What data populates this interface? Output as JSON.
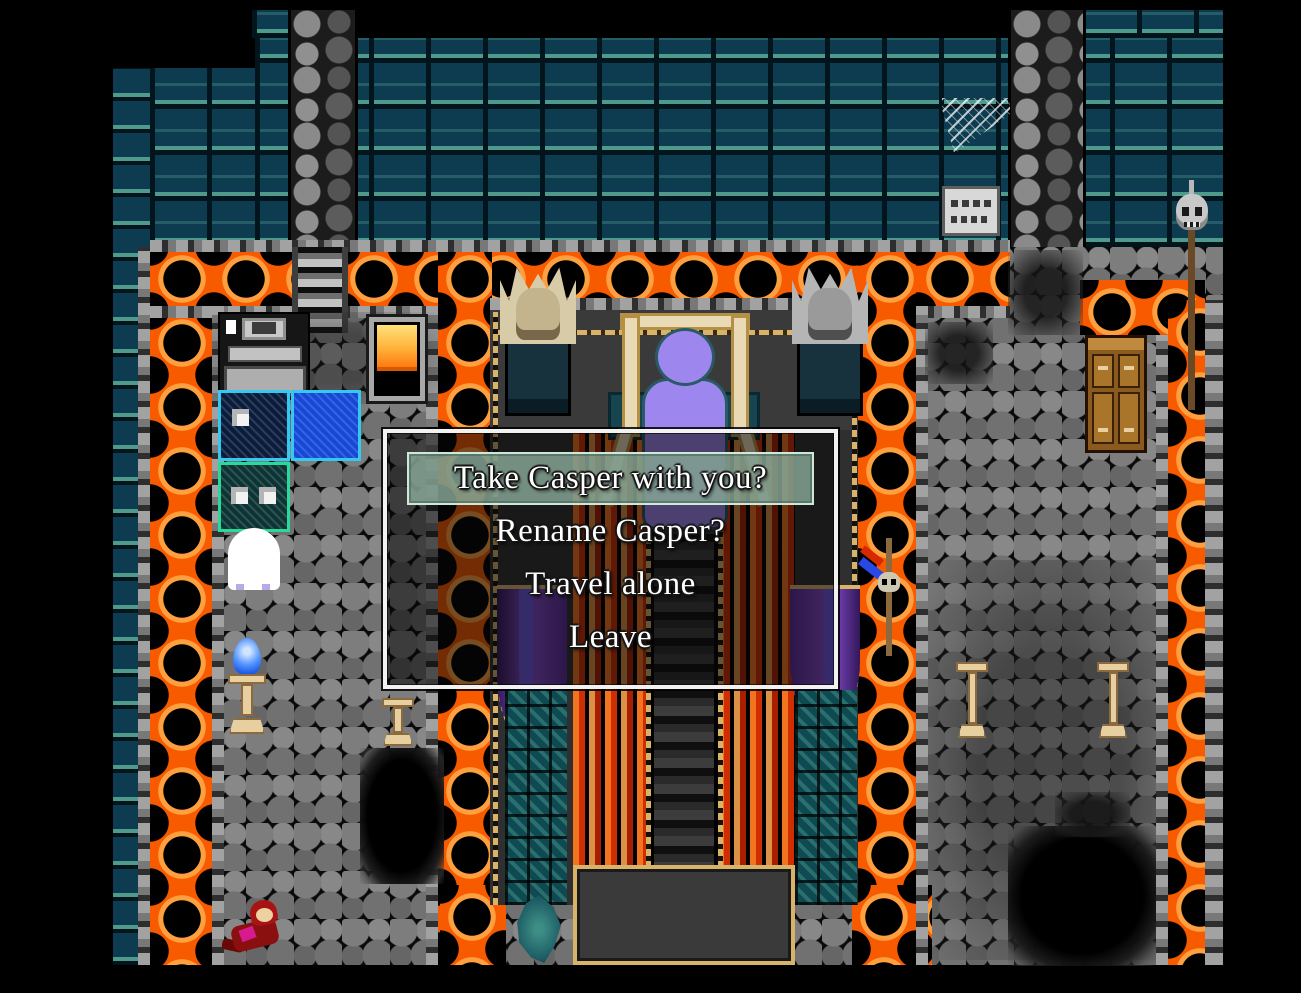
{
  "window": {
    "width": 1301,
    "height": 993,
    "background": "#000000"
  },
  "dialog": {
    "type": "choice-menu",
    "selected_index": 0,
    "options": [
      {
        "label": "Take Casper with you?",
        "selected": true
      },
      {
        "label": "Rename Casper?",
        "selected": false
      },
      {
        "label": "Travel alone",
        "selected": false
      },
      {
        "label": "Leave",
        "selected": false
      }
    ],
    "text_color": "#ffffff",
    "highlight_color": "#89aa99",
    "border_color": "#f2f2f2",
    "background": "rgba(8,8,8,0.55)"
  },
  "palette": {
    "lava_orange": "#f85a00",
    "lava_highlight": "#ffa040",
    "brick_teal_dark": "#0d3c50",
    "brick_teal_light": "#4f9a8c",
    "cobble_gray": "#7d7d7d",
    "alcove_wall": "#3a3a3a",
    "hall_floor": "#2f2f2f",
    "gold_trim": "#d9b36a",
    "curtain_purple": "#8a4fd0",
    "curtain_violet": "#6a5ae8",
    "carpet_flame_red": "#d83000",
    "carpet_flame_orange": "#ff7a20",
    "figure_purple": "#9e86ef",
    "throne_bone": "#ead9b5",
    "statue_cream": "#d8cba8",
    "statue_gray": "#b5b5b5",
    "table_navy": "#0a1c3c",
    "table_blue": "#1648d8",
    "table_teal": "#0c3434",
    "table_cyan_border": "#35c8f0",
    "table_green_border": "#2ad89a",
    "ghost_white": "#ffffff",
    "flame_blue": "#2a6af0",
    "cabinet_brown": "#8a5a1e",
    "skull_gray": "#c8c8c8",
    "blood_red": "#8a0c0c"
  },
  "scene": {
    "entities": [
      "teal-brick-wall",
      "stone-column-left",
      "stone-column-right",
      "spider-web",
      "wall-sign",
      "lava-moat",
      "cobblestone-floor",
      "descending-staircase",
      "throne-alcove",
      "purple-figure-on-throne",
      "gargoyle-statue-left",
      "gargoyle-statue-right",
      "purple-curtain-left",
      "purple-curtain-right",
      "flame-carpet-left",
      "flame-carpet-right",
      "grand-staircase",
      "stone-platform",
      "piano",
      "furnace",
      "map-table-navy",
      "map-table-blue",
      "map-table-teal",
      "ghost",
      "blue-candle-flame",
      "candle-stand",
      "skull-spear",
      "wooden-cabinet",
      "skull-lamp",
      "floor-pit-left",
      "floor-pit-right",
      "fallen-body",
      "teal-bush-left",
      "teal-bush-right"
    ]
  }
}
